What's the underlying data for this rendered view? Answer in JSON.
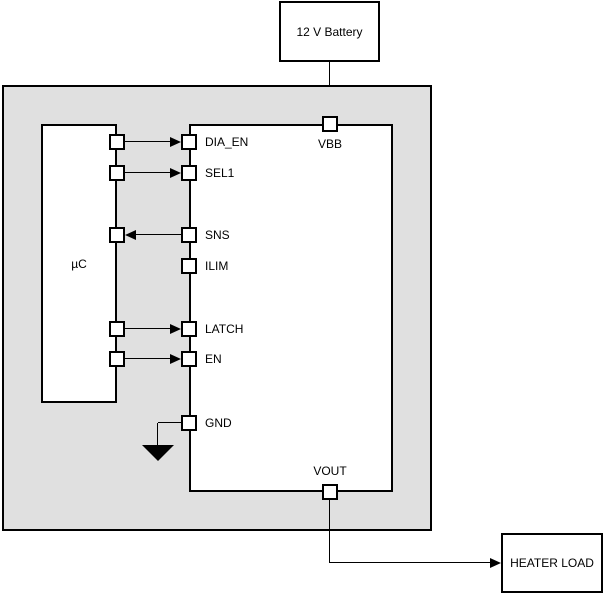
{
  "blocks": {
    "battery": {
      "label": "12 V Battery"
    },
    "mcu": {
      "label": "µC"
    },
    "heater": {
      "label": "HEATER LOAD"
    }
  },
  "pins": {
    "vbb": "VBB",
    "dia_en": "DIA_EN",
    "sel1": "SEL1",
    "sns": "SNS",
    "ilim": "ILIM",
    "latch": "LATCH",
    "en": "EN",
    "gnd": "GND",
    "vout": "VOUT"
  },
  "colors": {
    "module_fill": "#e0e0e0",
    "box_fill": "#ffffff",
    "line": "#000000"
  }
}
